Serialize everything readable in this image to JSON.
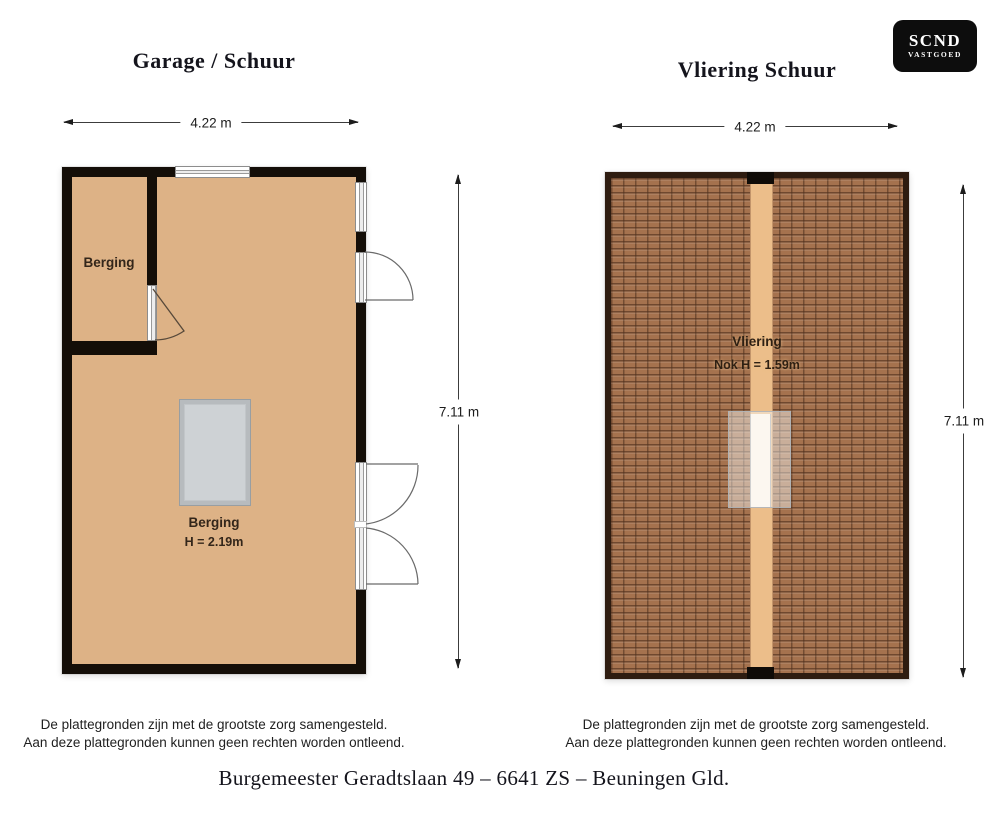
{
  "logo": {
    "primary": "SCND",
    "secondary": "VASTGOED"
  },
  "left_plan": {
    "title": "Garage / Schuur",
    "dim_width": "4.22 m",
    "dim_height": "7.11 m",
    "storage_room_label": "Berging",
    "main_room_label": "Berging",
    "main_room_height": "H = 2.19m"
  },
  "right_plan": {
    "title": "Vliering Schuur",
    "dim_width": "4.22 m",
    "dim_height": "7.11 m",
    "room_label": "Vliering",
    "room_height": "Nok H = 1.59m"
  },
  "disclaimer": {
    "line1": "De plattegronden zijn met de grootste zorg samengesteld.",
    "line2": "Aan deze plattegronden kunnen geen rechten worden ontleend."
  },
  "address": "Burgemeester Geradtslaan 49 – 6641 ZS – Beuningen Gld.",
  "colors": {
    "floor": "#ddb286",
    "wall": "#140e08",
    "roof_tile": "#a5724e",
    "roof_line": "#5e3c28",
    "roof_border": "#2e1c10",
    "ridge": "#ecbe8a",
    "hatch_fill": "#ced2d5",
    "hatch_border": "#b7bbbe",
    "logo_bg": "#0d0d0d",
    "dimension_line": "#3c3c3c"
  }
}
